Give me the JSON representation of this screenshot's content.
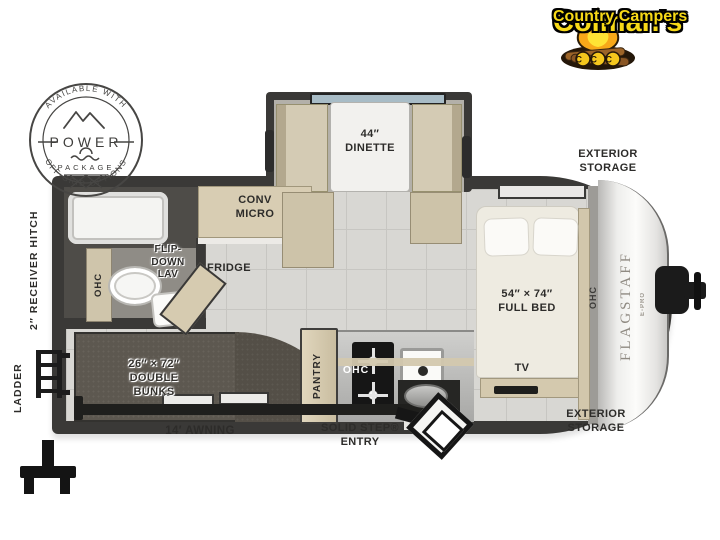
{
  "logo": {
    "name_line1": "Colman's",
    "name_line2": "Country Campers",
    "campfire_initials": "CCC"
  },
  "power_badge": {
    "arc_top": "AVAILABLE WITH",
    "title": "POWER",
    "subtitle": "PACKAGE",
    "arc_bottom": "OFF-GRID OPTIONS"
  },
  "floorplan": {
    "model": "FLAGSTAFF",
    "model_edition": "E-PRO",
    "labels": {
      "dinette": "44″\nDINETTE",
      "exterior_storage_top": "EXTERIOR\nSTORAGE",
      "exterior_storage_bottom": "EXTERIOR\nSTORAGE",
      "conv_micro": "CONV\nMICRO",
      "fridge": "FRIDGE",
      "flip_down_lav": "FLIP-\nDOWN\nLAV",
      "ohc_bath": "OHC",
      "ohc_kitchen": "OHC",
      "ohc_bed": "OHC",
      "full_bed": "54″ × 74″\nFULL BED",
      "tv": "TV",
      "double_bunks": "26″ × 72″\nDOUBLE\nBUNKS",
      "pantry": "PANTRY",
      "receiver_hitch": "2″ RECEIVER HITCH",
      "ladder": "LADDER",
      "awning": "14′ AWNING",
      "solid_step_entry": "SOLID STEP®\nENTRY"
    }
  },
  "colors": {
    "logo_yellow": "#f7d917",
    "wall_dark": "#3a3937",
    "cabinet_tan": "#d3c8ae",
    "floor_tile": "#d8d7d3",
    "carpet_dark": "#5d5850",
    "label_text": "#2d2c2a"
  }
}
